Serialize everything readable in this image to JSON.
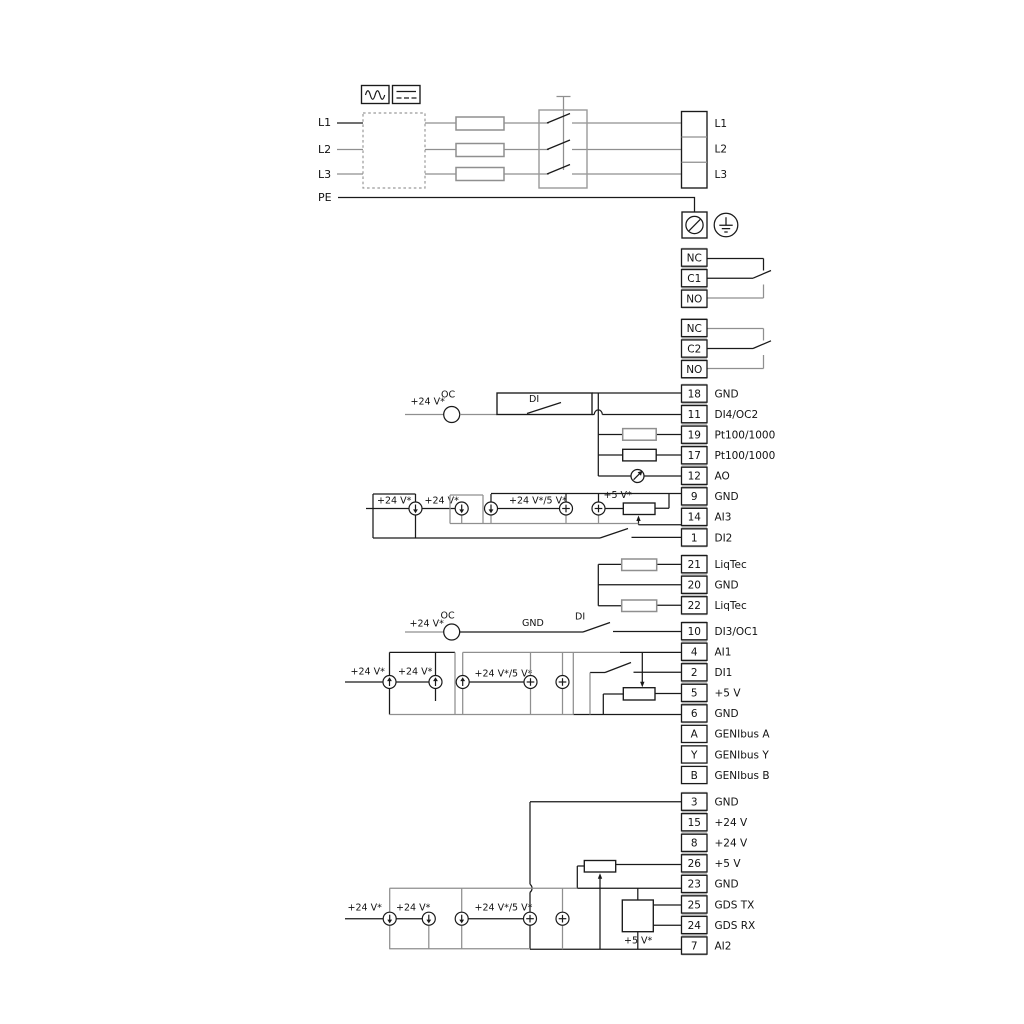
{
  "mains": {
    "left": [
      "L1",
      "L2",
      "L3",
      "PE"
    ],
    "right": [
      "L1",
      "L2",
      "L3"
    ]
  },
  "terminals": {
    "relay1": [
      {
        "no": "NC",
        "label": ""
      },
      {
        "no": "C1",
        "label": ""
      },
      {
        "no": "NO",
        "label": ""
      }
    ],
    "relay2": [
      {
        "no": "NC",
        "label": ""
      },
      {
        "no": "C2",
        "label": ""
      },
      {
        "no": "NO",
        "label": ""
      }
    ],
    "group_a": [
      {
        "no": "18",
        "label": "GND"
      },
      {
        "no": "11",
        "label": "DI4/OC2"
      },
      {
        "no": "19",
        "label": "Pt100/1000"
      },
      {
        "no": "17",
        "label": "Pt100/1000"
      },
      {
        "no": "12",
        "label": "AO"
      },
      {
        "no": "9",
        "label": "GND"
      },
      {
        "no": "14",
        "label": "AI3"
      },
      {
        "no": "1",
        "label": "DI2"
      }
    ],
    "group_b": [
      {
        "no": "21",
        "label": "LiqTec"
      },
      {
        "no": "20",
        "label": "GND"
      },
      {
        "no": "22",
        "label": "LiqTec"
      }
    ],
    "group_c": [
      {
        "no": "10",
        "label": "DI3/OC1"
      },
      {
        "no": "4",
        "label": "AI1"
      },
      {
        "no": "2",
        "label": "DI1"
      },
      {
        "no": "5",
        "label": "+5 V"
      },
      {
        "no": "6",
        "label": "GND"
      }
    ],
    "group_d": [
      {
        "no": "A",
        "label": "GENIbus A"
      },
      {
        "no": "Y",
        "label": "GENIbus Y"
      },
      {
        "no": "B",
        "label": "GENIbus B"
      }
    ],
    "group_e": [
      {
        "no": "3",
        "label": "GND"
      },
      {
        "no": "15",
        "label": "+24 V"
      },
      {
        "no": "8",
        "label": "+24 V"
      },
      {
        "no": "26",
        "label": "+5 V"
      },
      {
        "no": "23",
        "label": "GND"
      },
      {
        "no": "25",
        "label": "GDS TX"
      },
      {
        "no": "24",
        "label": "GDS RX"
      },
      {
        "no": "7",
        "label": "AI2"
      }
    ]
  },
  "annotations": {
    "plus24": "+24 V*",
    "plus24or5": "+24 V*/5 V*",
    "plus5": "+5 V*",
    "oc": "OC",
    "di": "DI",
    "gnd": "GND"
  },
  "colors": {
    "wire_black": "#1a1a1a",
    "wire_gray": "#8f8f8f",
    "cell_gap": "#c2c2c2"
  }
}
